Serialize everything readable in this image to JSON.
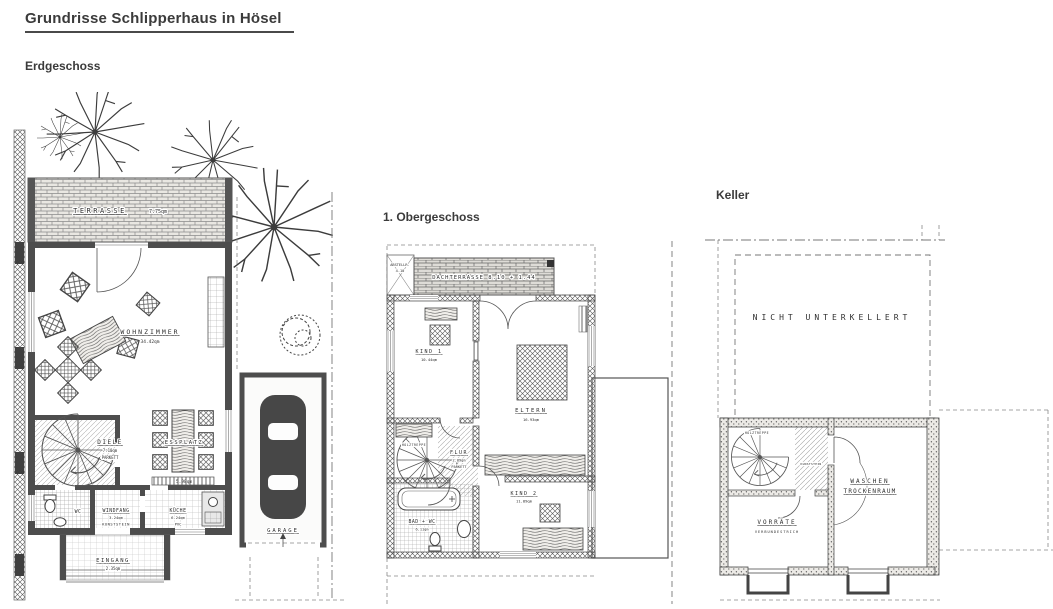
{
  "page": {
    "title": "Grundrisse Schlipperhaus in Hösel"
  },
  "erdgeschoss": {
    "heading": "Erdgeschoss",
    "terrasse": {
      "name": "TERRASSE",
      "area": "7.75qm"
    },
    "wohnzimmer": {
      "name": "WOHNZIMMER",
      "area": "34.42qm"
    },
    "diele": {
      "name": "DIELE",
      "area": "7.10qm",
      "floor": "PARKETT"
    },
    "essplatz": {
      "name": "ESSPLATZ",
      "area": "5.98qm"
    },
    "wc": {
      "name": "WC"
    },
    "windfang": {
      "name": "WINDFANG",
      "area": "3.24qm",
      "floor": "KUNSTSTEIN"
    },
    "kueche": {
      "name": "KÜCHE",
      "area": "6.24qm",
      "floor": "PVC"
    },
    "eingang": {
      "name": "EINGANG",
      "area": "2.35qm"
    },
    "garage": {
      "name": "GARAGE"
    }
  },
  "obergeschoss": {
    "heading": "1. Obergeschoss",
    "abstellraum": {
      "name": "ABSTELLR.",
      "area": "4.10"
    },
    "dachterrasse": {
      "label": "DACHTERRASSE 8.10 + 1.44"
    },
    "kind1": {
      "name": "KIND 1",
      "area": "10.44qm"
    },
    "eltern": {
      "name": "ELTERN",
      "area": "16.93qm"
    },
    "flur": {
      "name": "FLUR",
      "area": "2.89qm",
      "floor": "PARKETT"
    },
    "holztreppe": "HOLZTREPPE",
    "bad": {
      "name": "BAD + WC",
      "area": "6.11qm"
    },
    "kind2": {
      "name": "KIND 2",
      "area": "11.89qm"
    }
  },
  "keller": {
    "heading": "Keller",
    "nicht_unterkellert": "NICHT UNTERKELLERT",
    "holztreppe": "HOLZTREPPE",
    "kunststein": "KUNSTSTEIN",
    "waschen": {
      "line1": "WASCHEN",
      "line2": "TROCKENRAUM"
    },
    "vorraete": {
      "name": "VORRÄTE",
      "floor": "VERBUNDESTRICH"
    }
  }
}
